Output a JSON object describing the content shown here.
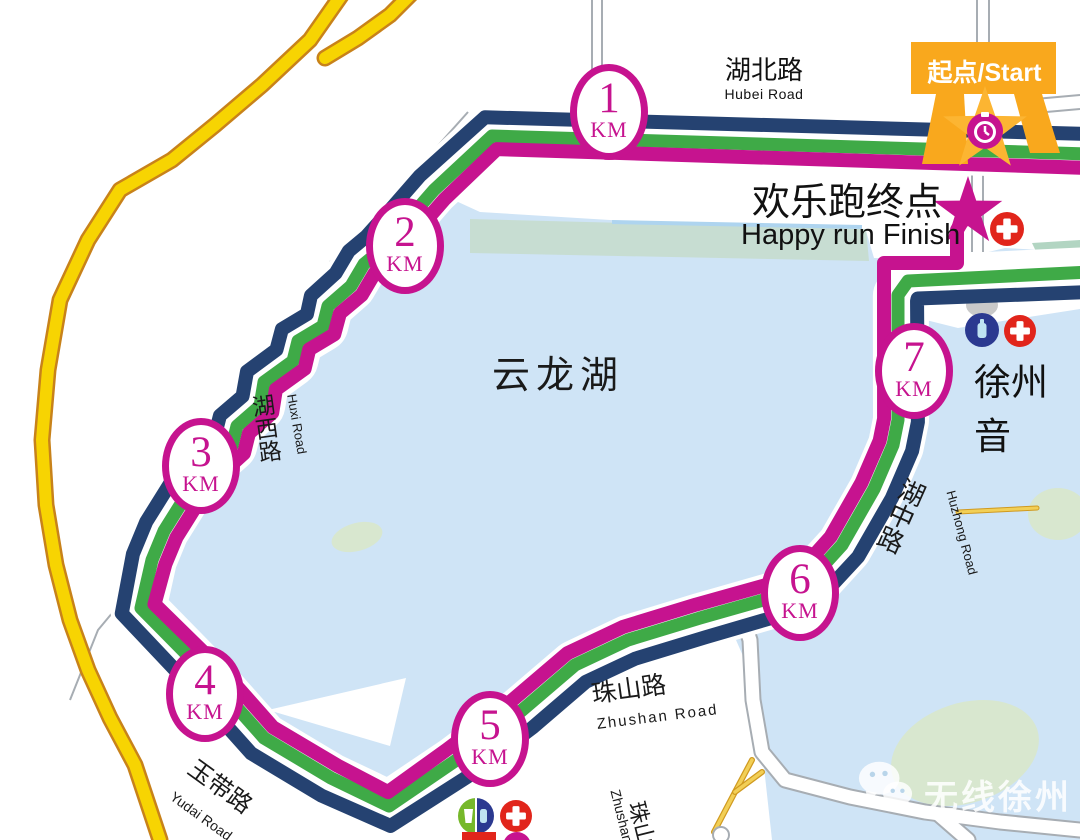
{
  "texts": {
    "start_banner": "起点/Start",
    "finish_cn": "欢乐跑终点",
    "finish_en": "Happy run Finish",
    "lake_name": "云龙湖",
    "hubei_cn": "湖北路",
    "hubei_en": "Hubei Road",
    "music_hall": "徐州音",
    "watermark": "无线徐州",
    "km_unit": "KM"
  },
  "colors": {
    "route_navy": "#254271",
    "route_green": "#3faa47",
    "route_magenta": "#c6138f",
    "highway_fill": "#f7d402",
    "highway_casing": "#c8821a",
    "gate_orange": "#f9a81d",
    "star_yellow": "#fcb532",
    "lake": "#cfe4f6",
    "sage": "#c7ddd2",
    "teal_patch": "#b2d5c2",
    "island": "#d8e7cf",
    "cross_red": "#e1251b",
    "bottle_navy": "#2b3990",
    "drink_green": "#76b82a",
    "bottle_fill": "#bfe3f2",
    "road_gray": "#a7adb3",
    "building_gray": "#c9c9c9",
    "stripe_blue": "#aed4ef"
  },
  "km_markers": [
    {
      "value": "1",
      "x": 609,
      "y": 112
    },
    {
      "value": "2",
      "x": 405,
      "y": 246
    },
    {
      "value": "3",
      "x": 201,
      "y": 466
    },
    {
      "value": "4",
      "x": 205,
      "y": 694
    },
    {
      "value": "5",
      "x": 490,
      "y": 739
    },
    {
      "value": "6",
      "x": 800,
      "y": 593
    },
    {
      "value": "7",
      "x": 914,
      "y": 371
    }
  ],
  "road_labels": [
    {
      "id": "huxi-road-cn",
      "text": "湖西路",
      "x": 248,
      "y": 396,
      "size": 23,
      "rot": -8,
      "vert": true
    },
    {
      "id": "huxi-road-en",
      "text": "Huxi Road",
      "x": 298,
      "y": 393,
      "size": 13,
      "rot": 80
    },
    {
      "id": "yudai-road-cn",
      "text": "玉带路",
      "x": 198,
      "y": 756,
      "size": 24,
      "rot": 36
    },
    {
      "id": "yudai-road-en",
      "text": "Yudai Road",
      "x": 176,
      "y": 789,
      "size": 14,
      "rot": 36
    },
    {
      "id": "zhushan-road-cn",
      "text": "珠山路",
      "x": 590,
      "y": 682,
      "size": 25,
      "rot": -8
    },
    {
      "id": "zhushan-road-en",
      "text": "Zhushan Road",
      "x": 596,
      "y": 717,
      "size": 15,
      "rot": -7,
      "ls": 2
    },
    {
      "id": "zhushan2-road-en",
      "text": "Zhushan Road",
      "x": 622,
      "y": 788,
      "size": 14,
      "rot": 76
    },
    {
      "id": "zhushan2-road-cn",
      "text": "珠山路",
      "x": 647,
      "y": 799,
      "size": 22,
      "rot": 76
    },
    {
      "id": "huzhong-road-cn",
      "text": "湖中路",
      "x": 903,
      "y": 474,
      "size": 26,
      "rot": 24,
      "vert": true
    },
    {
      "id": "huzhong-road-en",
      "text": "Huzhong Road",
      "x": 957,
      "y": 489,
      "size": 13,
      "rot": 75
    }
  ],
  "route": {
    "centerline": [
      [
        1090,
        154
      ],
      [
        492,
        136
      ],
      [
        434,
        190
      ],
      [
        407,
        221
      ],
      [
        380,
        251
      ],
      [
        364,
        264
      ],
      [
        351,
        286
      ],
      [
        328,
        306
      ],
      [
        323,
        326
      ],
      [
        298,
        341
      ],
      [
        293,
        361
      ],
      [
        264,
        382
      ],
      [
        260,
        406
      ],
      [
        237,
        426
      ],
      [
        232,
        446
      ],
      [
        206,
        469
      ],
      [
        189,
        491
      ],
      [
        164,
        531
      ],
      [
        152,
        560
      ],
      [
        141,
        608
      ],
      [
        216,
        684
      ],
      [
        264,
        738
      ],
      [
        331,
        778
      ],
      [
        389,
        806
      ],
      [
        455,
        761
      ],
      [
        520,
        712
      ],
      [
        575,
        665
      ],
      [
        628,
        640
      ],
      [
        700,
        618
      ],
      [
        802,
        589
      ],
      [
        842,
        545
      ],
      [
        874,
        489
      ],
      [
        893,
        445
      ],
      [
        898,
        420
      ],
      [
        898,
        295
      ],
      [
        908,
        281
      ],
      [
        1090,
        272
      ]
    ],
    "lines": [
      {
        "name": "navy",
        "offset": 20,
        "width": 14,
        "color": "#254271"
      },
      {
        "name": "green",
        "offset": 0,
        "width": 13,
        "color": "#3faa47"
      },
      {
        "name": "magenta",
        "offset": -14,
        "width": 14,
        "color": "#c6138f",
        "end_index": 35
      }
    ],
    "spur_magenta": [
      [
        884,
        302
      ],
      [
        884,
        263
      ],
      [
        957,
        263
      ],
      [
        957,
        230
      ],
      [
        966,
        215
      ]
    ],
    "casing": {
      "offset": 3,
      "width": 56,
      "color": "#ffffff"
    }
  },
  "map": {
    "lake_top_edge": [
      [
        1080,
        252
      ],
      [
        1005,
        248
      ],
      [
        955,
        260
      ],
      [
        874,
        258
      ],
      [
        866,
        231
      ],
      [
        610,
        220
      ],
      [
        480,
        212
      ],
      [
        445,
        196
      ]
    ],
    "lake_bottom_edge": [
      [
        736,
        640
      ],
      [
        750,
        672
      ],
      [
        763,
        758
      ],
      [
        772,
        840
      ],
      [
        1080,
        840
      ]
    ],
    "shore_slice": [
      2,
      30
    ],
    "shore_offset": -24,
    "sage_band": [
      [
        470,
        219
      ],
      [
        866,
        229
      ],
      [
        869,
        261
      ],
      [
        470,
        253
      ]
    ],
    "blue_stripe": [
      [
        612,
        222
      ],
      [
        862,
        227
      ]
    ],
    "teal_patch": [
      [
        1032,
        243
      ],
      [
        1080,
        240
      ],
      [
        1080,
        266
      ],
      [
        1042,
        264
      ]
    ],
    "islands": [
      {
        "cx": 357,
        "cy": 537,
        "rx": 26,
        "ry": 14,
        "rot": -15
      },
      {
        "cx": 855,
        "cy": 527,
        "rx": 14,
        "ry": 8,
        "rot": -20
      },
      {
        "cx": 849,
        "cy": 557,
        "rx": 16,
        "ry": 7,
        "rot": -15
      },
      {
        "cx": 1058,
        "cy": 514,
        "rx": 30,
        "ry": 26,
        "rot": 0
      },
      {
        "cx": 965,
        "cy": 753,
        "rx": 76,
        "ry": 50,
        "rot": -18
      }
    ],
    "highway_main": [
      [
        345,
        -10
      ],
      [
        310,
        40
      ],
      [
        262,
        85
      ],
      [
        215,
        125
      ],
      [
        172,
        160
      ],
      [
        120,
        190
      ],
      [
        88,
        240
      ],
      [
        60,
        300
      ],
      [
        48,
        370
      ],
      [
        42,
        440
      ],
      [
        46,
        505
      ],
      [
        56,
        565
      ],
      [
        70,
        620
      ],
      [
        88,
        670
      ],
      [
        110,
        718
      ],
      [
        135,
        765
      ],
      [
        160,
        840
      ]
    ],
    "highway_branch": [
      [
        415,
        -10
      ],
      [
        390,
        15
      ],
      [
        358,
        38
      ],
      [
        325,
        58
      ]
    ],
    "white_road": [
      [
        744,
        622
      ],
      [
        750,
        640
      ],
      [
        753,
        700
      ],
      [
        762,
        752
      ],
      [
        785,
        780
      ],
      [
        850,
        797
      ],
      [
        925,
        812
      ],
      [
        1000,
        822
      ],
      [
        1080,
        830
      ]
    ],
    "white_road_branch": [
      [
        938,
        814
      ],
      [
        968,
        840
      ]
    ],
    "yellow_road_a": [
      [
        752,
        760
      ],
      [
        735,
        792
      ],
      [
        714,
        832
      ]
    ],
    "yellow_road_b": [
      [
        735,
        792
      ],
      [
        762,
        772
      ]
    ],
    "yellow_road_c": [
      [
        958,
        512
      ],
      [
        1037,
        508
      ]
    ],
    "road_end_circle": {
      "cx": 721,
      "cy": 835,
      "r": 8
    },
    "gray_lines": [
      [
        [
          592,
          0
        ],
        [
          592,
          108
        ]
      ],
      [
        [
          602,
          0
        ],
        [
          602,
          112
        ]
      ],
      [
        [
          977,
          0
        ],
        [
          977,
          44
        ]
      ],
      [
        [
          989,
          0
        ],
        [
          989,
          44
        ]
      ],
      [
        [
          972,
          150
        ],
        [
          972,
          252
        ]
      ],
      [
        [
          983,
          150
        ],
        [
          983,
          252
        ]
      ],
      [
        [
          1035,
          99
        ],
        [
          1080,
          95
        ]
      ],
      [
        [
          1035,
          113
        ],
        [
          1080,
          109
        ]
      ],
      [
        [
          468,
          112
        ],
        [
          385,
          205
        ],
        [
          330,
          262
        ]
      ],
      [
        [
          138,
          582
        ],
        [
          98,
          630
        ],
        [
          70,
          700
        ]
      ]
    ],
    "beach_wedge": [
      [
        268,
        710
      ],
      [
        406,
        678
      ],
      [
        390,
        746
      ]
    ],
    "music_wedge": [
      [
        902,
        307
      ],
      [
        1080,
        302
      ],
      [
        1080,
        309
      ],
      [
        958,
        328
      ],
      [
        906,
        315
      ]
    ],
    "building": {
      "cx": 982,
      "cy": 305,
      "rx": 16,
      "ry": 12
    }
  },
  "markers": {
    "gate": {
      "banner": [
        [
          911,
          42
        ],
        [
          1056,
          42
        ],
        [
          1056,
          94
        ],
        [
          911,
          94
        ]
      ],
      "leg_left": [
        [
          936,
          94
        ],
        [
          964,
          94
        ],
        [
          968,
          164
        ],
        [
          922,
          164
        ]
      ],
      "leg_right": [
        [
          1014,
          94
        ],
        [
          1042,
          94
        ],
        [
          1060,
          153
        ],
        [
          1030,
          153
        ]
      ]
    },
    "star_start": {
      "cx": 985,
      "cy": 130,
      "R": 44,
      "r": 17.5
    },
    "stopwatch": {
      "cx": 985,
      "cy": 131,
      "r": 18
    },
    "star_finish": {
      "cx": 968,
      "cy": 212,
      "R": 36,
      "r": 14
    },
    "crosses": [
      {
        "cx": 1007,
        "cy": 229,
        "r": 17
      },
      {
        "cx": 1020,
        "cy": 331,
        "r": 16
      },
      {
        "cx": 516,
        "cy": 816,
        "r": 16
      }
    ],
    "bottle_station": {
      "cx": 982,
      "cy": 330,
      "r": 17
    },
    "drink_station": {
      "cx": 476,
      "cy": 816,
      "r": 18
    },
    "partial_red_rect": {
      "x": 462,
      "y": 832,
      "w": 34,
      "h": 8
    },
    "partial_magenta_circle": {
      "cx": 517,
      "cy": 846,
      "r": 14
    }
  }
}
